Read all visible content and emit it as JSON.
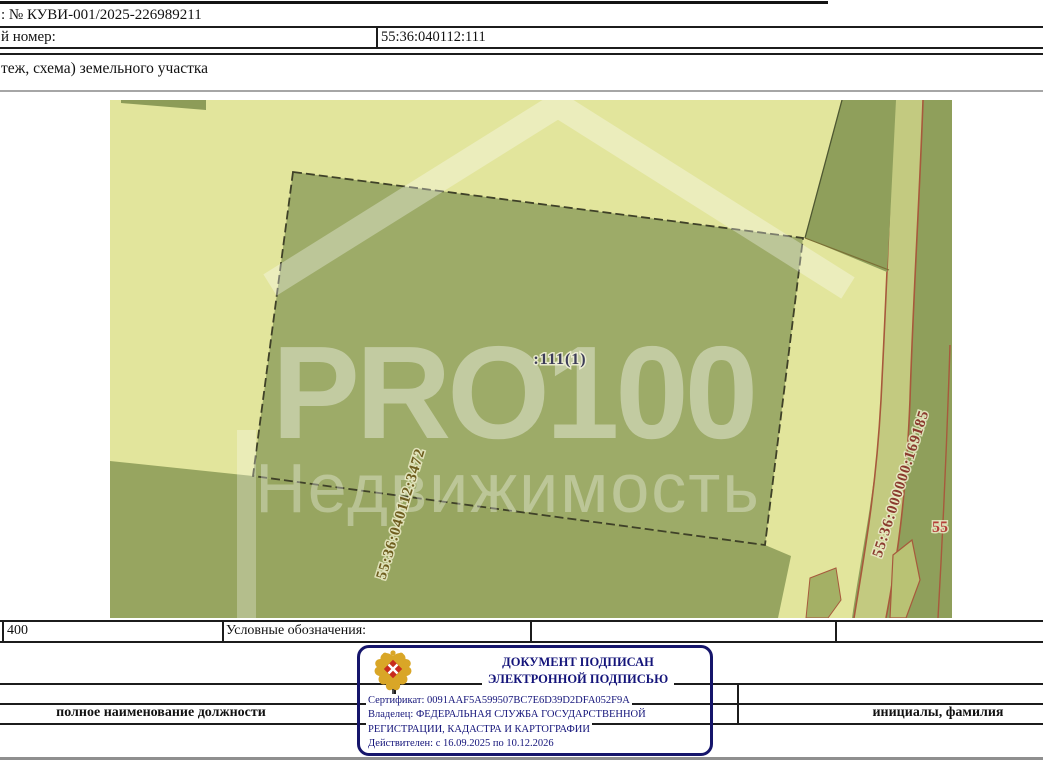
{
  "header": {
    "request_number_line": ": № КУВИ-001/2025-226989211",
    "cadastral_number_label": "й номер:",
    "cadastral_number_value": "55:36:040112:111",
    "section_title": "теж, схема) земельного участка"
  },
  "map": {
    "parcel_label": ":111(1)",
    "adjacent_parcel_number_left": "55:36:040112:3472",
    "adjacent_parcel_number_right": "55:36:000000:169185",
    "edge_parcel_number": "55",
    "watermark": {
      "line1": "PRO100",
      "line2": "Недвижимость"
    },
    "colors": {
      "background_light": "#e2e59c",
      "parcel_fill": "#9dab68",
      "green_dark": "#8f9f5b",
      "green_bottom": "#97a560",
      "road_fill": "#c3ca80",
      "boundary_red": "#a7593c",
      "parcel_label_color": "#3c3c58",
      "left_number_color": "#6e5d1e",
      "right_number_color": "#8a3a2e",
      "edge_number_color": "#b5403a"
    }
  },
  "scale_row": {
    "scale_value": "400",
    "legend_label": "Условные обозначения:"
  },
  "stamp": {
    "title_line1": "ДОКУМЕНТ ПОДПИСАН",
    "title_line2": "ЭЛЕКТРОННОЙ ПОДПИСЬЮ",
    "certificate_line": "Сертификат: 0091AAF5A599507BC7E6D39D2DFA052F9A",
    "owner_line1": "Владелец: ФЕДЕРАЛЬНАЯ СЛУЖБА ГОСУДАРСТВЕННОЙ",
    "owner_line2": "РЕГИСТРАЦИИ, КАДАСТРА И КАРТОГРАФИИ",
    "validity_line": "Действителен: с 16.09.2025 по 10.12.2026",
    "border_color": "#15156b",
    "text_color": "#14147a"
  },
  "footer": {
    "position_placeholder": "полное наименование должности",
    "name_placeholder": "инициалы, фамилия"
  }
}
